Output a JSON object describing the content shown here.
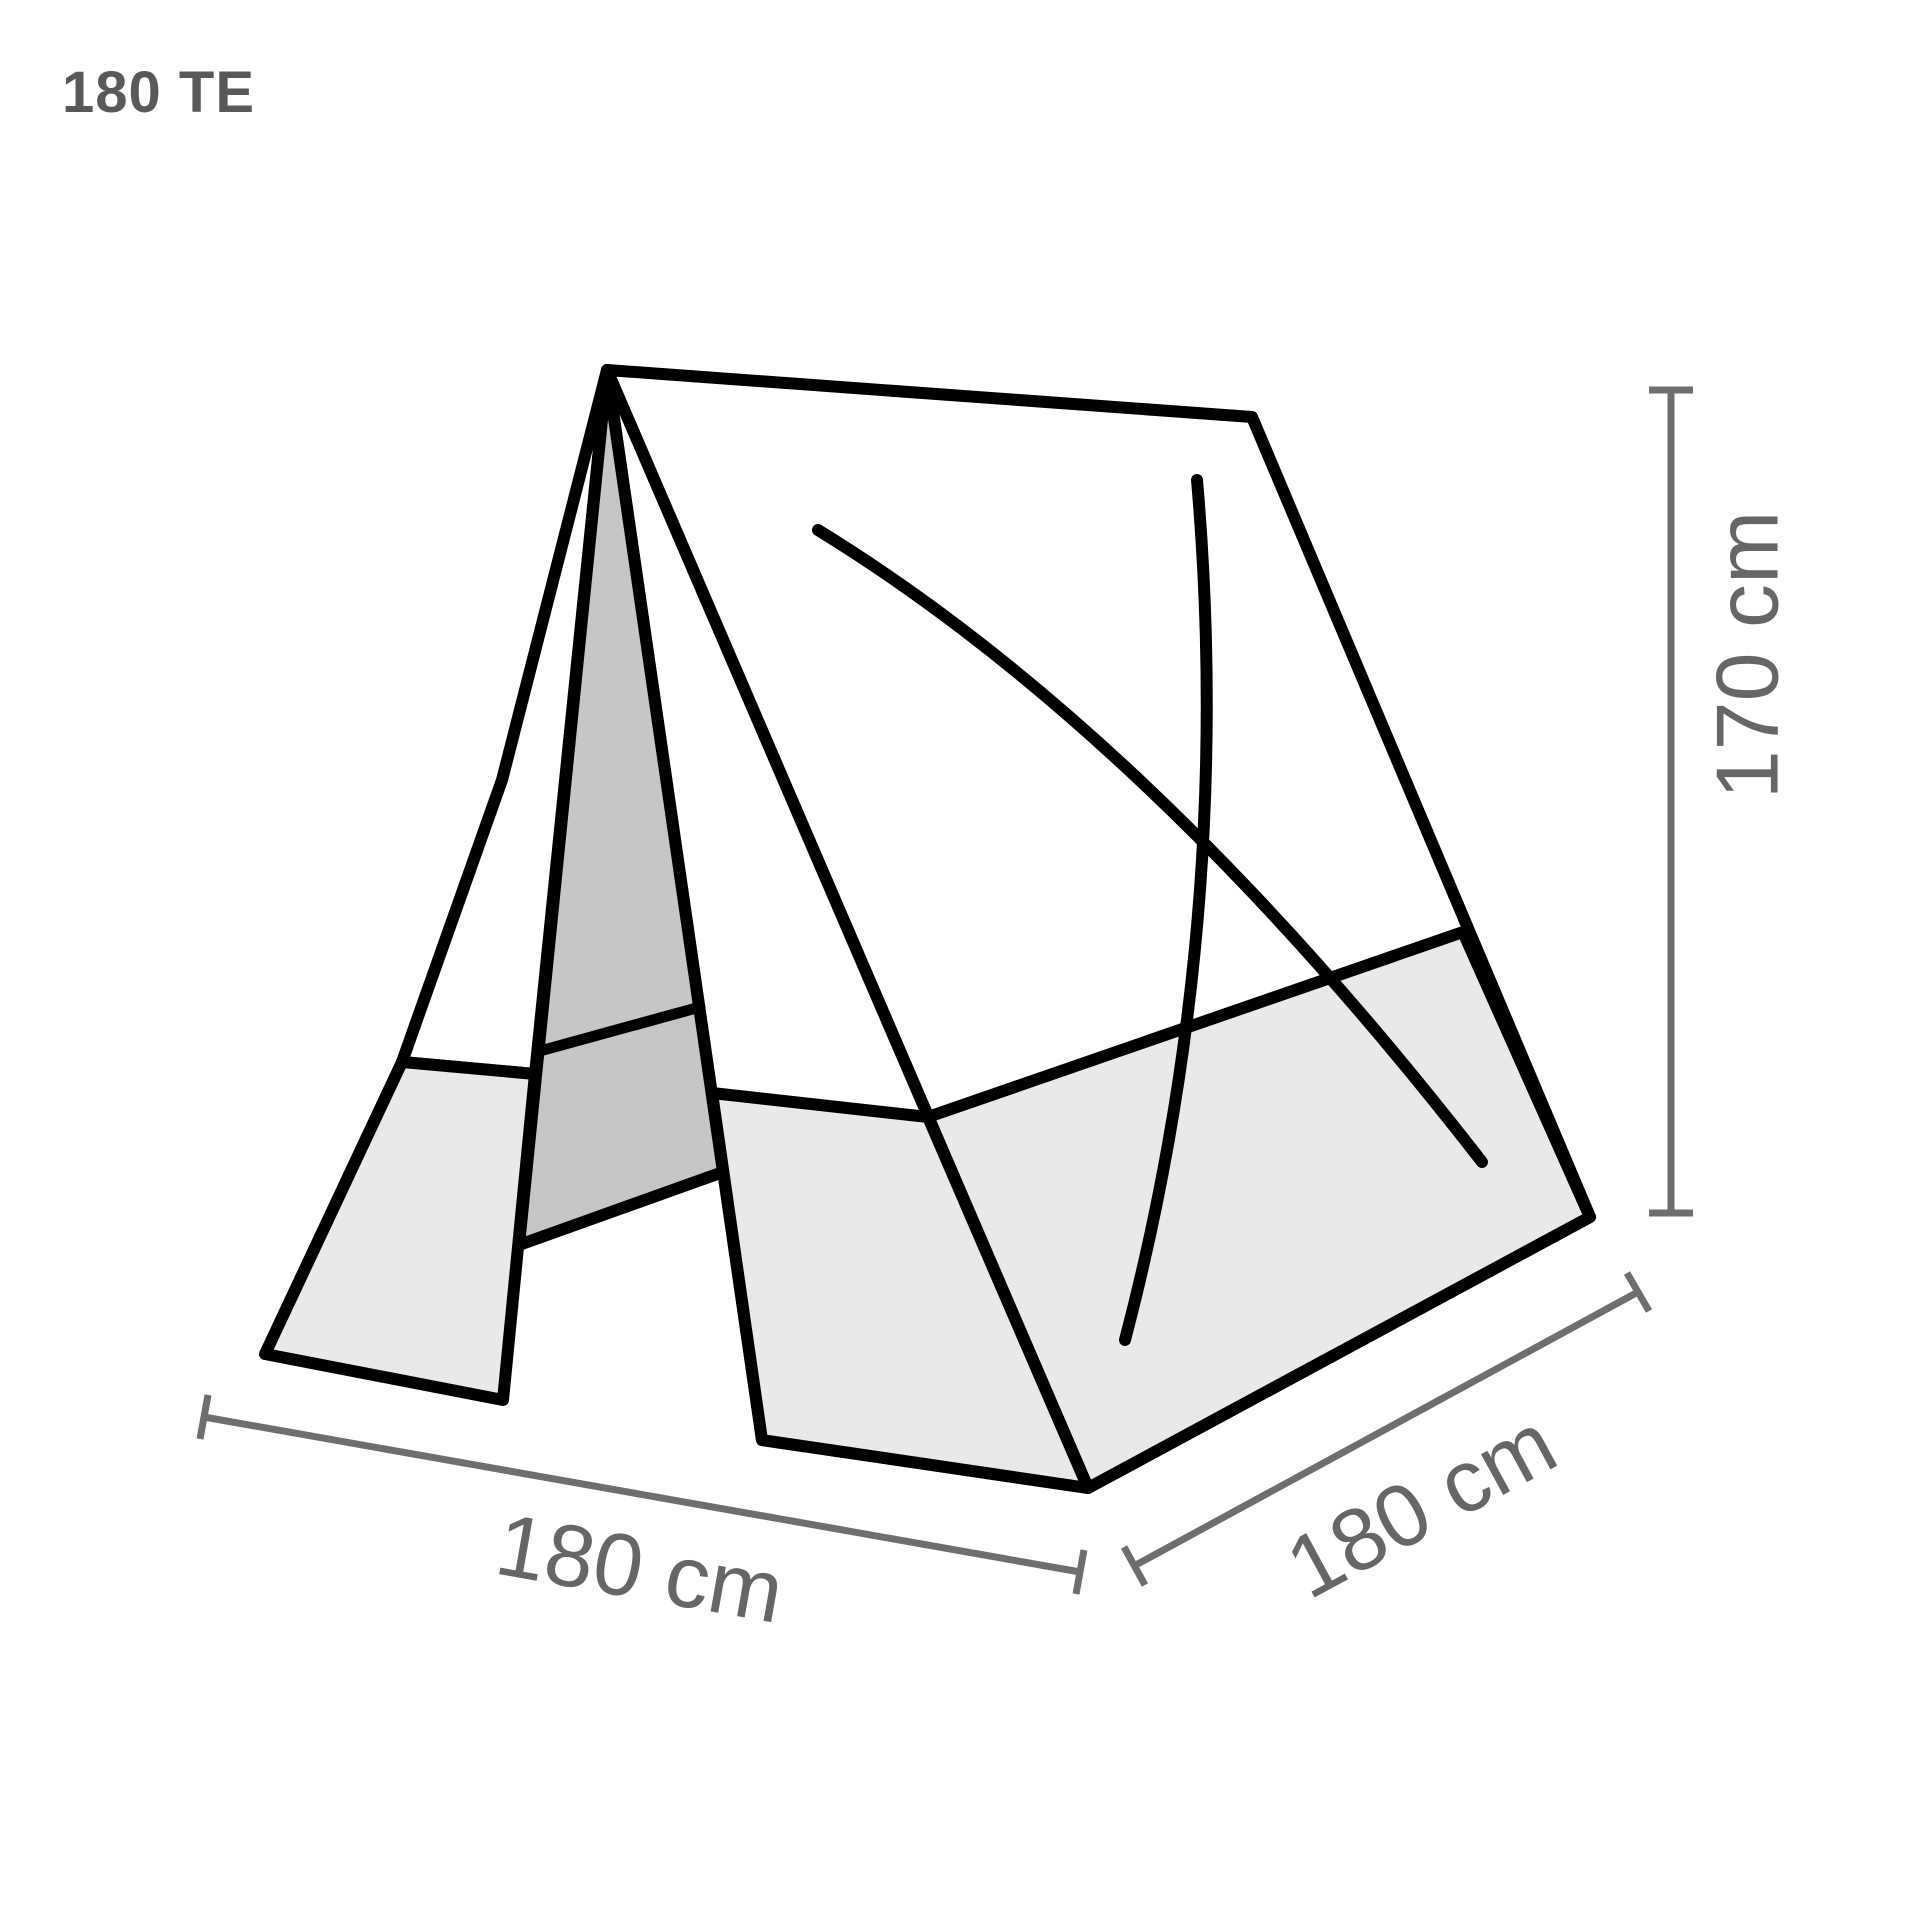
{
  "title": "180 TE",
  "colors": {
    "background": "#ffffff",
    "outline": "#000000",
    "panel_fill": "#ffffff",
    "skirt_fill": "#e9e9ea",
    "door_fill": "#c4c7c6",
    "dimension_line": "#6e6e6e",
    "dimension_text": "#666666",
    "title_text": "#58595b"
  },
  "diagram": {
    "dimensions": {
      "height": "170 cm",
      "width": "180 cm",
      "depth": "180 cm"
    }
  }
}
